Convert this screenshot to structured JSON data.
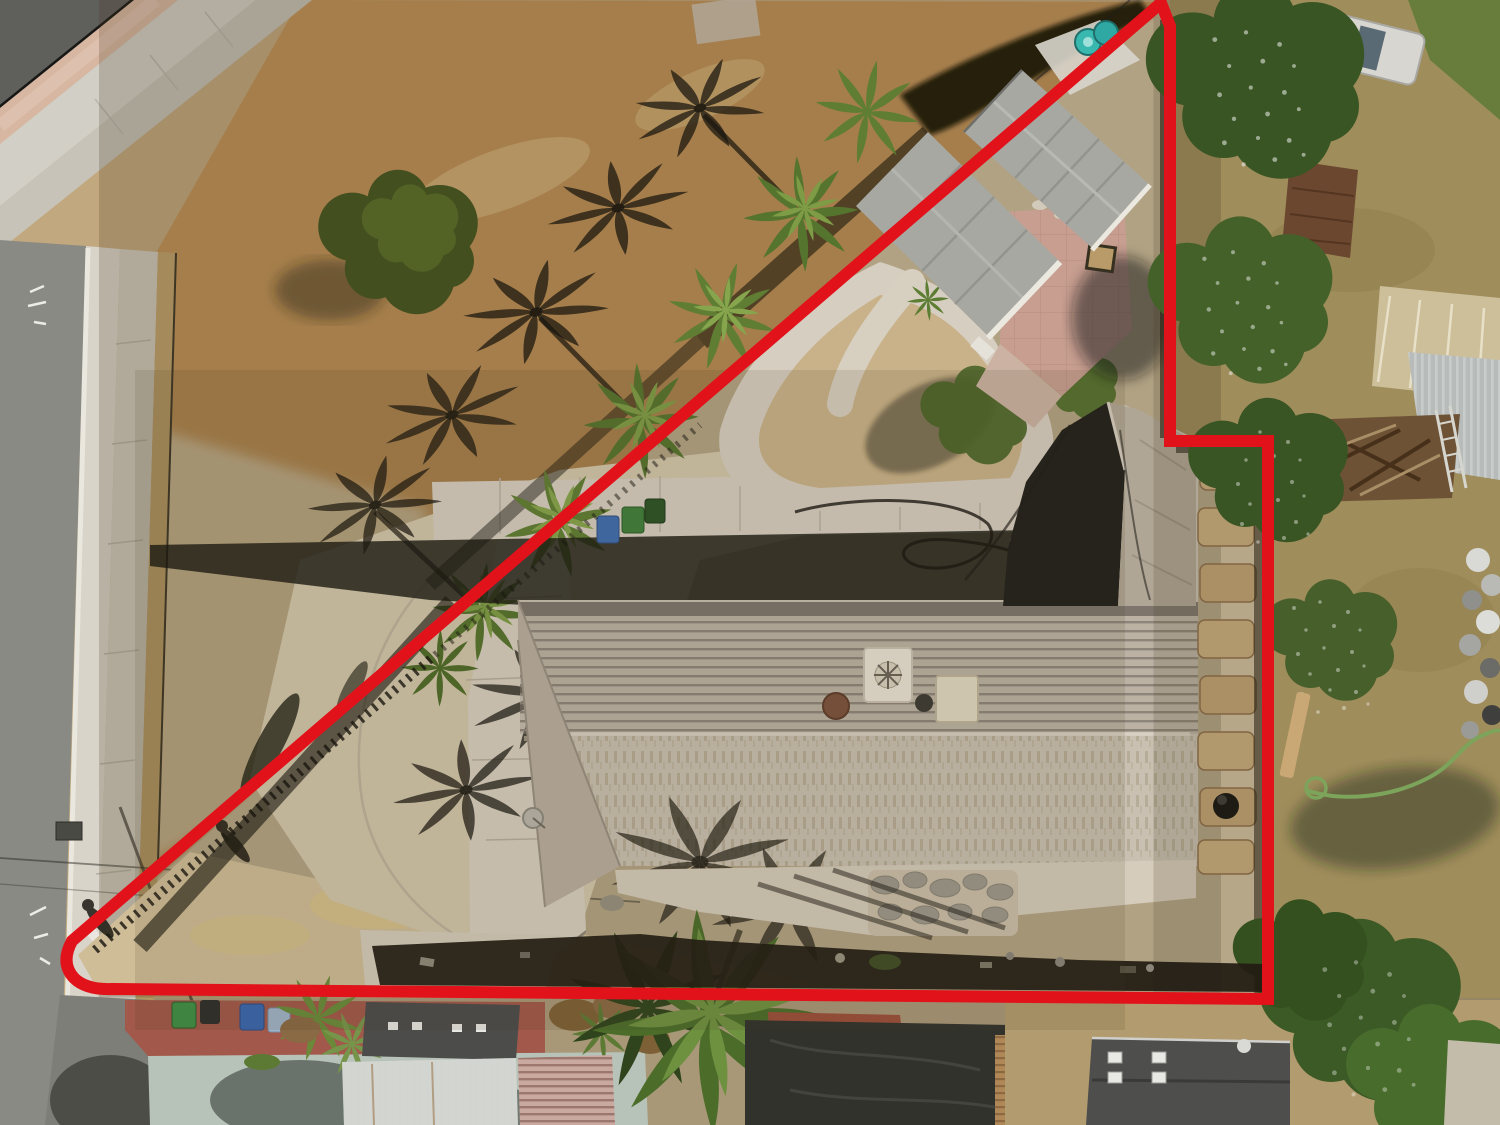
{
  "scene": {
    "type": "aerial-drone-photo",
    "subject": "residential-parcel-with-red-property-boundary-overlay"
  },
  "boundary": {
    "color": "#e2121a",
    "stroke_width": 12,
    "path": "M 1161 3 L 72 941 Q 60 963 74 978 Q 86 990 112 989 L 1268 999 L 1268 441 L 1170 441 L 1170 26 Z"
  },
  "palette": {
    "field_gold": "#c09257",
    "field_light": "#d3c3a0",
    "inside_dirt": "#cfc0a0",
    "corner_dirt": "#cfbd97",
    "dry_grass_right": "#b3a069",
    "bottom_dirt": "#a89878",
    "road_asphalt": "#8a8a85",
    "road_dark": "#5f5f5c",
    "sidewalk": "#cfcabd",
    "gutter_concrete": "#d8d4ca",
    "pink_median": "#d7b7a2",
    "concrete_walk": "#d6cec0",
    "roof_upper": "#a1988c",
    "roof_lower": "#c9c0b1",
    "roof_wing_shadow": "#20201a",
    "garage_roof": "#a8a8a3",
    "patio_pink": "#c79e90",
    "tree_dark": "#3a5524",
    "tree_mid": "#55742e",
    "palm_green": "#5f7e33",
    "tarp_black": "#32322d",
    "teal_concrete": "#b7c2b9",
    "redbrown_pavement": "#a2584a",
    "neighbor_roof_dark": "#4e4e4c",
    "brown_shed": "#6b4730",
    "tan_building": "#cdbf9a",
    "bin_blue": "#3f6db0",
    "bin_green": "#3f8f46",
    "bin_lightblue": "#9fb3c8",
    "barrel_teal": "#39b8b0",
    "hose_green": "#7ca45a",
    "paver_tan": "#c9ad7e",
    "flagstone_gray": "#9d988c"
  }
}
